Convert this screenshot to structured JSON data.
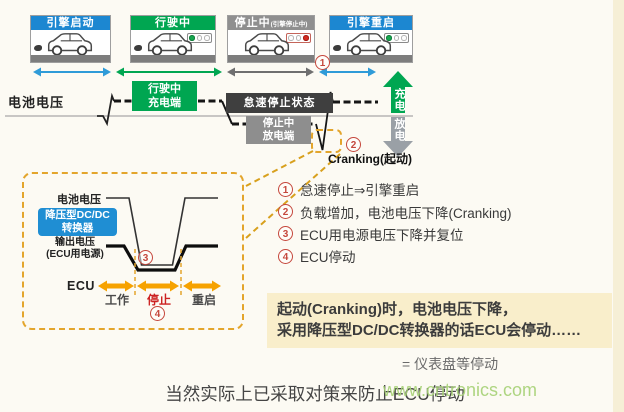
{
  "scenes": [
    {
      "title": "引擎启动",
      "header_color": "#1c87d1",
      "exhaust": true
    },
    {
      "title": "行驶中",
      "header_color": "#00a651",
      "light": [
        "lit-green",
        "off",
        "off"
      ],
      "exhaust": true
    },
    {
      "title": "停止中",
      "title_small": "(引擎停止中)",
      "header_color": "#8f8f8f",
      "light": [
        "off",
        "off",
        "lit-red"
      ],
      "exhaust": false
    },
    {
      "title": "引擎重启",
      "header_color": "#1c87d1",
      "light": [
        "lit-green",
        "off",
        "off"
      ],
      "exhaust": true
    }
  ],
  "timeline": {
    "battery_label": "电池电压",
    "phase_driving_charging": "行驶中\n充电端",
    "phase_idle_stop": "怠速停止状态",
    "phase_stop_discharging": "停止中\n放电端",
    "cranking_label": "Cranking(起动)",
    "charge_arrow": "充电",
    "discharge_arrow": "放电",
    "battery_states": [
      {
        "phase": "引擎启动",
        "state": "cranking dip below mid line"
      },
      {
        "phase": "行驶中",
        "state": "high level (charging)"
      },
      {
        "phase": "停止中(怠速停止)",
        "state": "low level (discharging)"
      },
      {
        "phase": "引擎重启",
        "state": "deep cranking dip then back to high level"
      }
    ]
  },
  "markers": {
    "m1": "1",
    "m2": "2",
    "m3": "3",
    "m4": "4"
  },
  "callout": {
    "battery_label": "电池电压",
    "converter": "降压型DC/DC\n转换器",
    "output_label": "输出电压\n(ECU用电源)",
    "ecu": "ECU",
    "phase_work": "工作",
    "phase_stop": "停止",
    "phase_restart": "重启"
  },
  "notes": [
    {
      "num": "1",
      "text": "怠速停止⇒引擎重启"
    },
    {
      "num": "2",
      "text": "负载增加，电池电压下降(Cranking)"
    },
    {
      "num": "3",
      "text": "ECU用电源电压下降并复位"
    },
    {
      "num": "4",
      "text": "ECU停动"
    }
  ],
  "highlight": {
    "line1": "起动(Cranking)时，电池电压下降，",
    "line2": "采用降压型DC/DC转换器的话ECU会停动……",
    "equals": "= 仪表盘等停动"
  },
  "caption": "当然实际上已采取对策来防止ECU停动",
  "watermark": "www.cntronics.com",
  "colors": {
    "header_blue": "#1c87d1",
    "header_green": "#00a651",
    "header_gray": "#8f8f8f",
    "dashed_callout": "#e3a52c",
    "ecu_arrow_orange": "#f6a200",
    "marker_red": "#c5473c",
    "highlight_bg": "#f9eecb",
    "watermark_green": "#a6d175"
  }
}
